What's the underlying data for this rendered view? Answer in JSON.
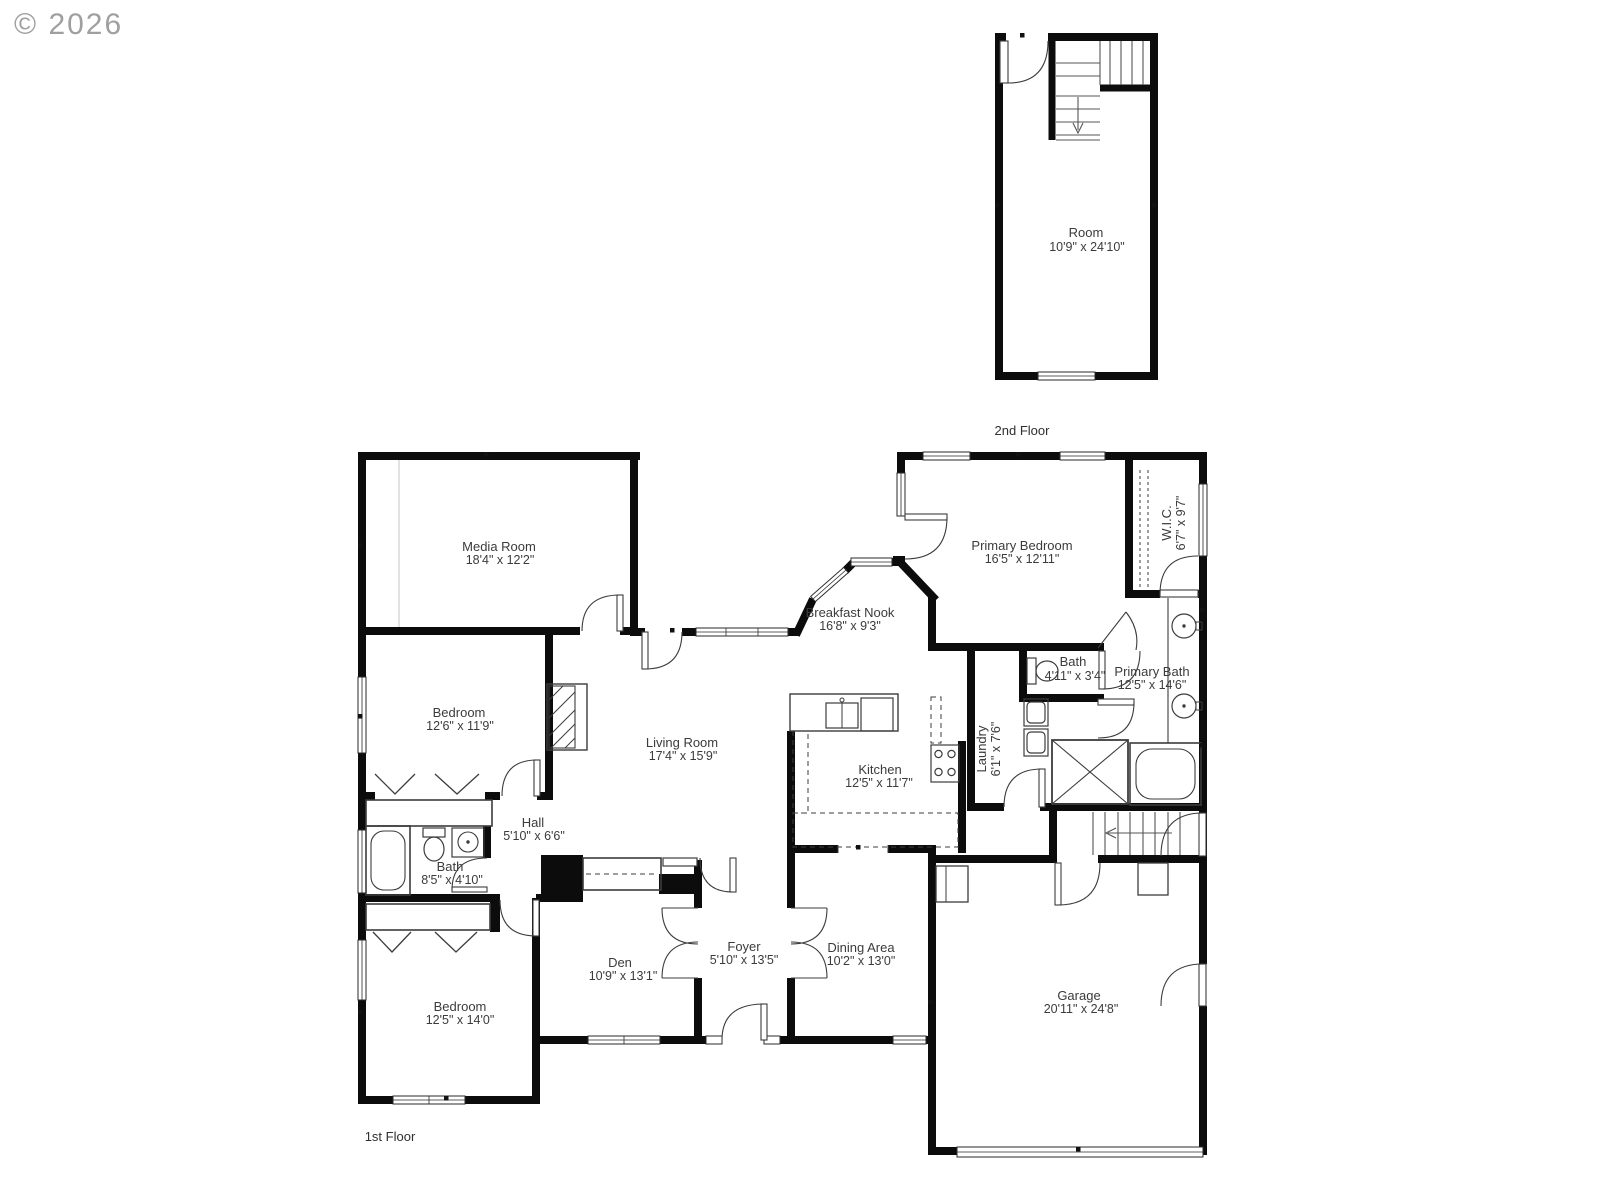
{
  "watermark": "© 2026",
  "colors": {
    "wall": "#0c0c0c",
    "thin_line": "#3c3c3c",
    "label_text": "#3b3b3b",
    "watermark_gray": "#8f8f8f",
    "background": "#ffffff"
  },
  "floors": {
    "second": {
      "caption": "2nd Floor",
      "rooms": {
        "room": {
          "name": "Room",
          "dims": "10'9\" x 24'10\""
        }
      }
    },
    "first": {
      "caption": "1st Floor",
      "rooms": {
        "media": {
          "name": "Media Room",
          "dims": "18'4\" x 12'2\""
        },
        "bedroom1": {
          "name": "Bedroom",
          "dims": "12'6\" x 11'9\""
        },
        "hall": {
          "name": "Hall",
          "dims": "5'10\" x 6'6\""
        },
        "bath1": {
          "name": "Bath",
          "dims": "8'5\" x 4'10\""
        },
        "bedroom2": {
          "name": "Bedroom",
          "dims": "12'5\" x 14'0\""
        },
        "den": {
          "name": "Den",
          "dims": "10'9\" x 13'1\""
        },
        "foyer": {
          "name": "Foyer",
          "dims": "5'10\" x 13'5\""
        },
        "dining": {
          "name": "Dining Area",
          "dims": "10'2\" x 13'0\""
        },
        "living": {
          "name": "Living Room",
          "dims": "17'4\" x 15'9\""
        },
        "kitchen": {
          "name": "Kitchen",
          "dims": "12'5\" x 11'7\""
        },
        "nook": {
          "name": "Breakfast Nook",
          "dims": "16'8\" x 9'3\""
        },
        "pbed": {
          "name": "Primary Bedroom",
          "dims": "16'5\" x 12'11\""
        },
        "wic": {
          "name": "W.I.C.",
          "dims": "6'7\" x 9'7\""
        },
        "bath2": {
          "name": "Bath",
          "dims": "4'11\" x 3'4\""
        },
        "pbath": {
          "name": "Primary Bath",
          "dims": "12'5\" x 14'6\""
        },
        "laundry": {
          "name": "Laundry",
          "dims": "6'1\" x 7'6\""
        },
        "garage": {
          "name": "Garage",
          "dims": "20'11\" x 24'8\""
        }
      }
    }
  }
}
